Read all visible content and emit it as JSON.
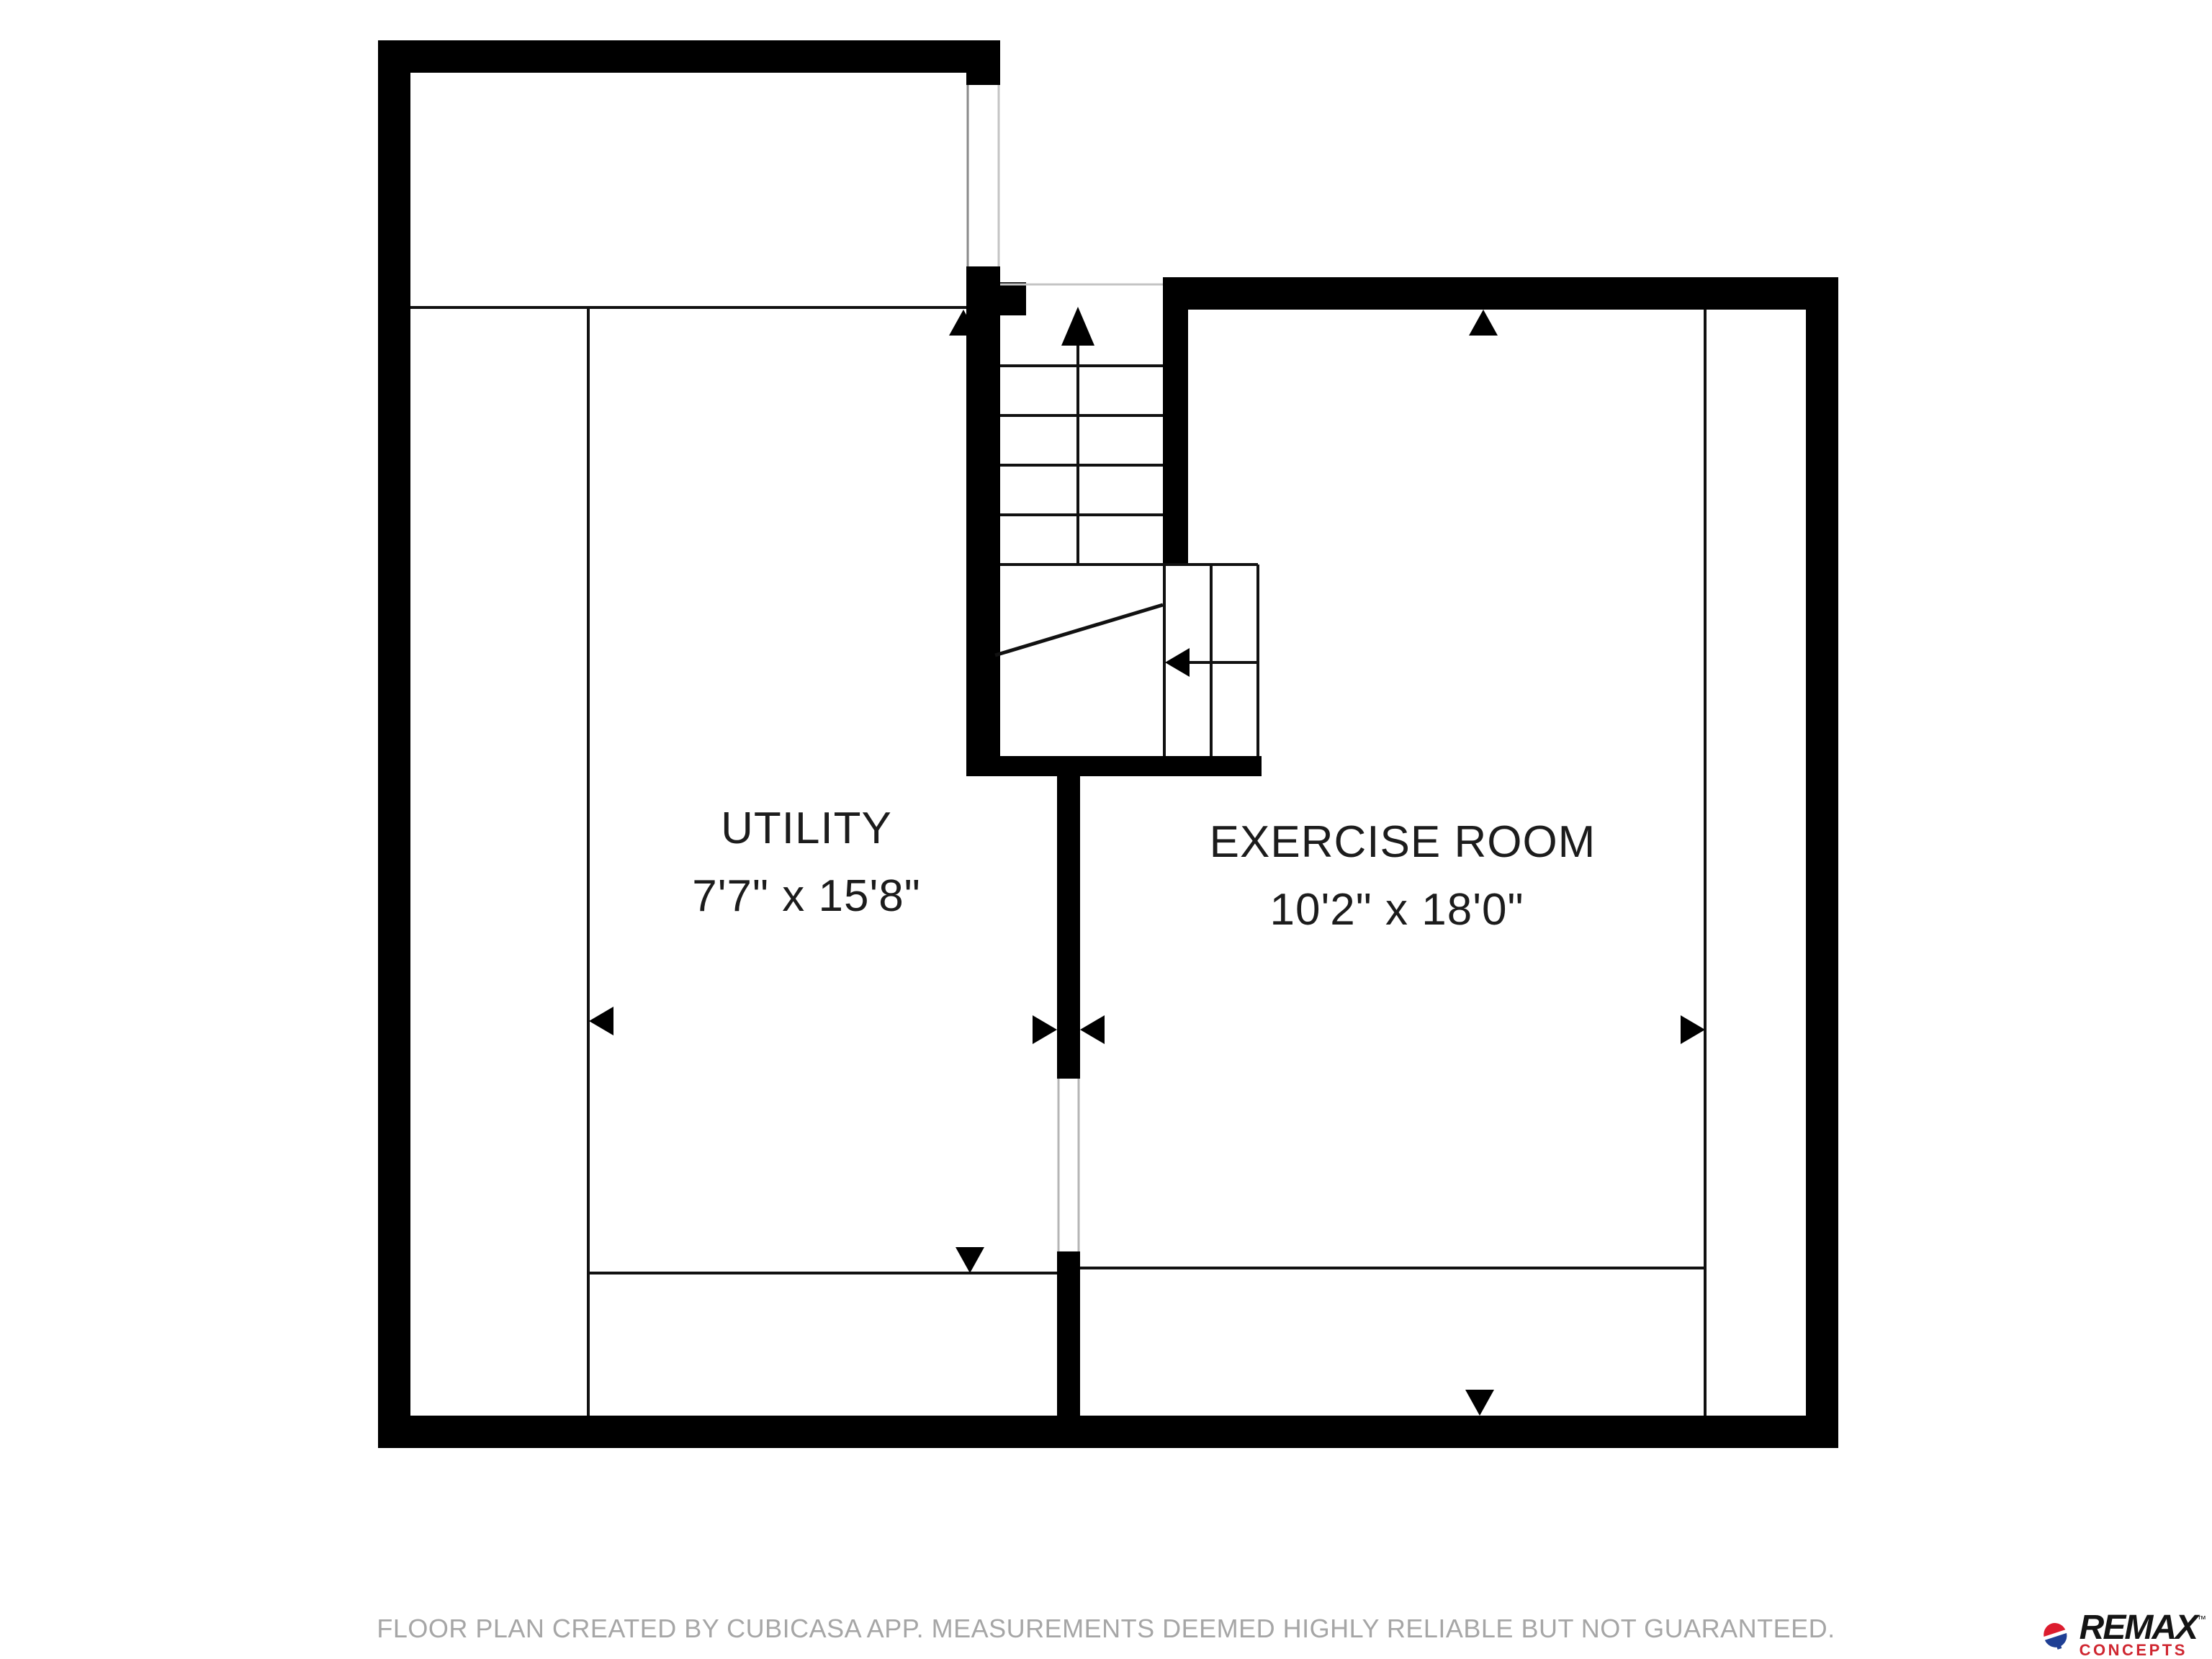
{
  "floor_plan": {
    "rooms": [
      {
        "name": "UTILITY",
        "dimensions": "7'7\" x 15'8\""
      },
      {
        "name": "EXERCISE ROOM",
        "dimensions": "10'2\" x 18'0\""
      }
    ],
    "features": [
      "staircase-up-arrow",
      "staircase-winder-left-arrow",
      "room-measurement-arrows",
      "window-opening",
      "door-opening"
    ]
  },
  "footer": {
    "disclaimer": "FLOOR PLAN CREATED BY CUBICASA APP. MEASUREMENTS DEEMED HIGHLY RELIABLE BUT NOT GUARANTEED."
  },
  "logo": {
    "brand": "REMAX",
    "trademark": "™",
    "sub_brand": "CONCEPTS",
    "icon": "remax-balloon-icon"
  },
  "colors": {
    "wall": "#000000",
    "label_text": "#1c1c1c",
    "disclaimer_text": "#a6a6a6",
    "remax_black": "#141414",
    "remax_red": "#cf2630",
    "balloon_red": "#dc1c2e",
    "balloon_blue": "#1f3f94"
  }
}
